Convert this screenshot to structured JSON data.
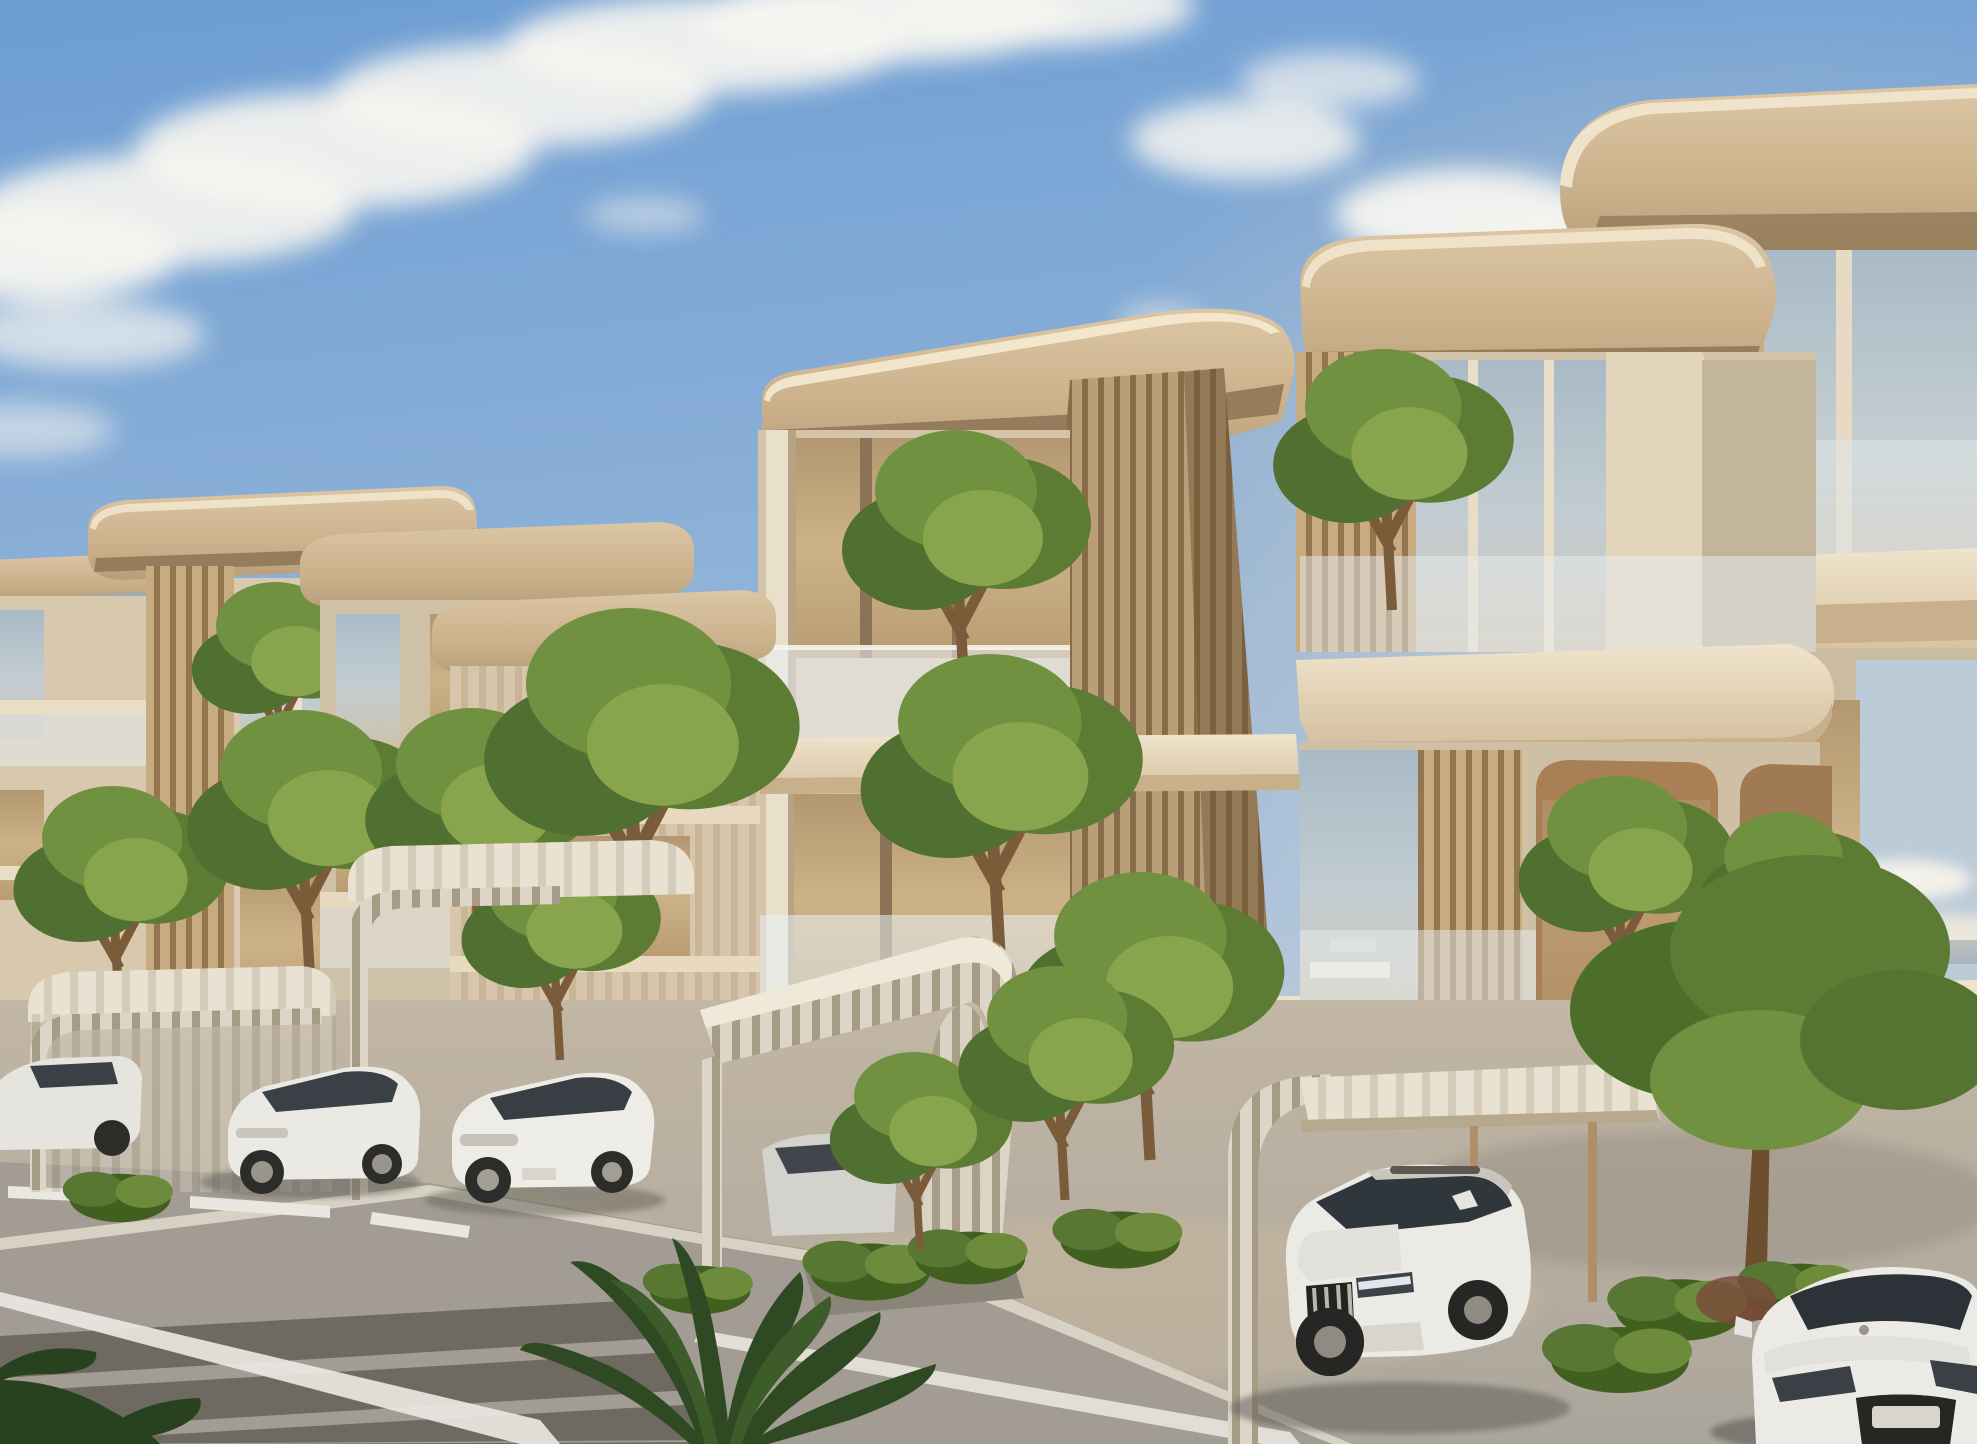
{
  "scene": {
    "type": "architectural-exterior-render",
    "description": "Golden-hour photorealistic rendering of a modern low-rise residential complex. Cream stone buildings with rounded cantilevered roof slabs, vertical timber-slat fin walls, glass balustrade balconies planted with green trees. Curved timber-rib carports shelter white cars along a paved parking apron; a street with crosswalk stripes crosses the lower-left corner; tropical foliage frames the foreground.",
    "time_of_day": "late afternoon golden hour",
    "sky": "blue with wispy diagonal clouds upper-left and small cumulus right horizon",
    "camera": "street-level three-quarter view looking along the building row"
  },
  "objects": {
    "buildings": [
      {
        "name": "far-left-block",
        "floors": 3,
        "features": [
          "roof slab",
          "glass balconies"
        ]
      },
      {
        "name": "left-block",
        "floors": 3,
        "features": [
          "timber slat fin",
          "corner glass",
          "balcony trees"
        ]
      },
      {
        "name": "mid-block",
        "floors": 3,
        "features": [
          "rounded roof slab",
          "vertical mullion glazing"
        ]
      },
      {
        "name": "central-tower",
        "floors": 4,
        "features": [
          "large rounded roof slab",
          "full-height timber slat fin",
          "stacked glass balconies with trees"
        ]
      },
      {
        "name": "right-block",
        "floors": 4,
        "features": [
          "curved balcony slabs",
          "rounded arch openings with trees",
          "skyline reflections in glass"
        ]
      },
      {
        "name": "far-right-block",
        "floors": 4,
        "features": [
          "top-corner roof slab",
          "stacked curved balconies"
        ]
      }
    ],
    "vehicles": [
      {
        "name": "white-suv",
        "color": "white",
        "position": "center-right under flat carport canopy"
      },
      {
        "name": "white-sports-car",
        "color": "white",
        "position": "bottom-right corner, front cropped"
      },
      {
        "name": "white-sedan-1",
        "color": "white",
        "position": "left carport"
      },
      {
        "name": "white-sedan-2",
        "color": "white",
        "position": "left-center carport"
      },
      {
        "name": "partial-cars-left-edge",
        "color": "white/silver",
        "position": "far left edge"
      },
      {
        "name": "silver-car-central-carport",
        "color": "silver",
        "position": "under curved central canopy"
      }
    ],
    "street": {
      "elements": [
        "gray asphalt road lower-left",
        "dark crosswalk stripes",
        "white lane edge lines",
        "white dashes",
        "light curb",
        "paved parking apron"
      ]
    },
    "vegetation": [
      "street trees",
      "balcony trees",
      "clipped hedges",
      "planter shrubs",
      "foreground palm fronds",
      "dark corner leaves"
    ],
    "carports": [
      "arched timber-rib canopy left",
      "arched timber-rib canopy mid-left",
      "curved metal-rib canopy central",
      "flat white canopy right with slender timber posts"
    ]
  },
  "palette": {
    "sky_top": "#6d9dd3",
    "sky_mid": "#9bb9da",
    "sky_horizon": "#d8d2c6",
    "cloud": "#f7f5f0",
    "roof_top": "#d3bc9a",
    "roof_under": "#947c5c",
    "roof_rim": "#f2e7cf",
    "facade_light": "#dbcbb2",
    "facade_mid": "#cdbda4",
    "facade_shadow": "#b29c7f",
    "slat_wood": "#c9ab81",
    "slat_gap": "#93754f",
    "glass_cool": "#b9c6ce",
    "glass_warm": "#c8ad83",
    "glass_rail": "#eef4f8",
    "slab_face": "#ecdfc7",
    "slab_shade": "#c8b08d",
    "terracotta_wall": "#bb9064",
    "green_dark": "#33501f",
    "green_mid": "#5d7c33",
    "green_light": "#88a44c",
    "trunk": "#7a5c3a",
    "pavement": "#b5aea2",
    "pavement_warm": "#c8b8a2",
    "road": "#a29c94",
    "road_dark_stripe": "#6e6a62",
    "line_white": "#eceae4",
    "car_white": "#ebe9e4",
    "car_glass": "#31383e",
    "canopy_rib": "#ddd6c6"
  }
}
